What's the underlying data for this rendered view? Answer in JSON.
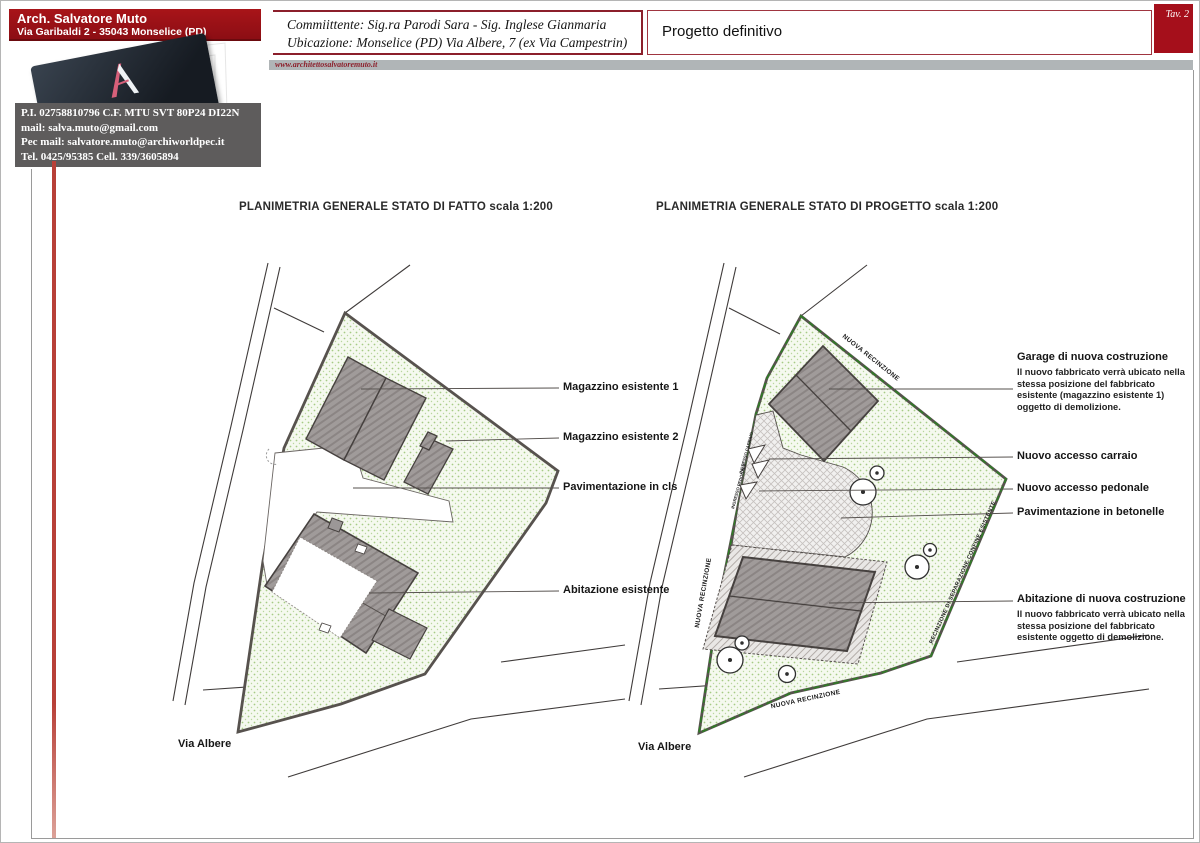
{
  "sheet": {
    "tav_label": "Tav. 2",
    "project_title": "Progetto definitivo",
    "website": "www.architettosalvatoremuto.it"
  },
  "architect": {
    "name": "Arch. Salvatore Muto",
    "address": "Via Garibaldi 2 - 35043 Monselice (PD)",
    "card_caption": "Architettura e Design",
    "vat_line": "P.I. 02758810796 C.F. MTU SVT 80P24 DI22N",
    "mail_line": "mail: salva.muto@gmail.com",
    "pec_line": "Pec mail: salvatore.muto@archiworldpec.it",
    "tel_line": "Tel. 0425/95385 Cell. 339/3605894"
  },
  "commission": {
    "client_line": "Commiittente: Sig.ra Parodi Sara - Sig. Inglese Gianmaria",
    "location_line": "Ubicazione: Monselice (PD) Via Albere, 7 (ex Via Campestrin)"
  },
  "plan_left": {
    "title": "PLANIMETRIA GENERALE STATO DI FATTO scala 1:200",
    "street": "Via Albere",
    "label_magazzino1": "Magazzino esistente 1",
    "label_magazzino2": "Magazzino esistente 2",
    "label_paving": "Pavimentazione in cls",
    "label_house": "Abitazione esistente"
  },
  "plan_right": {
    "title": "PLANIMETRIA GENERALE STATO DI PROGETTO scala 1:200",
    "street": "Via Albere",
    "garage_title": "Garage di nuova costruzione",
    "garage_note": "Il nuovo fabbricato verrà ubicato nella stessa posizione del fabbricato esistente (magazzino esistente 1) oggetto di demolizione.",
    "label_access_car": "Nuovo accesso carraio",
    "label_access_ped": "Nuovo accesso pedonale",
    "label_paving": "Pavimentazione in betonelle",
    "house_title": "Abitazione di nuova costruzione",
    "house_note": "Il nuovo fabbricato verrà ubicato nella stessa posizione del fabbricato esistente oggetto di demolizione.",
    "fence_top": "NUOVA RECINZIONE",
    "fence_left": "NUOVA RECINZIONE",
    "fence_bottom": "NUOVA RECINZIONE",
    "fence_right": "RECINZIONE DI SEPARAZIONE CONFINE ESISTENTE",
    "gate_car": "INGRESSO CARRAIO",
    "gate_ped": "INGRESSO PEDONALE"
  },
  "colors": {
    "accent_red": "#9d1118",
    "tav_red": "#a50f1b",
    "fence_green": "#2f7d25",
    "parcel_green": "#f5f9ef"
  }
}
